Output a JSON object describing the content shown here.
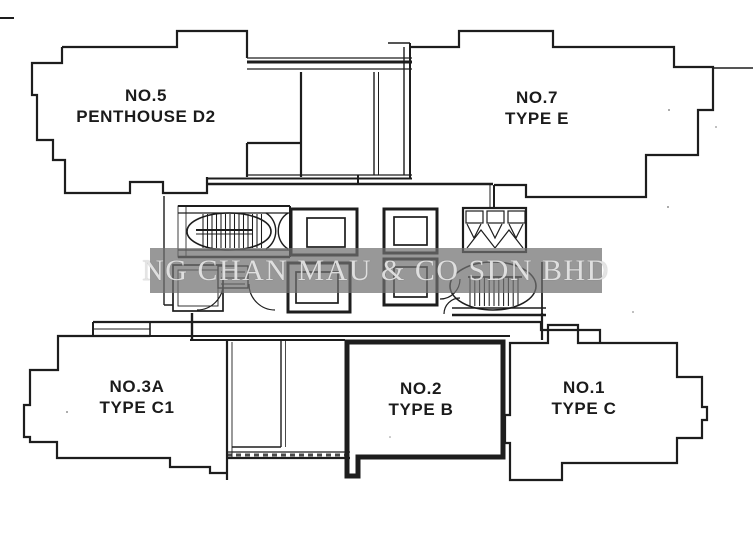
{
  "watermark": {
    "text": "NG CHAN MAU & CO SDN BHD"
  },
  "units": [
    {
      "id": "no5",
      "number": "NO.5",
      "type": "PENTHOUSE D2",
      "highlighted": false
    },
    {
      "id": "no7",
      "number": "NO.7",
      "type": "TYPE E",
      "highlighted": false
    },
    {
      "id": "no3a",
      "number": "NO.3A",
      "type": "TYPE C1",
      "highlighted": false
    },
    {
      "id": "no2",
      "number": "NO.2",
      "type": "TYPE B",
      "highlighted": true
    },
    {
      "id": "no1",
      "number": "NO.1",
      "type": "TYPE C",
      "highlighted": false
    }
  ],
  "colors": {
    "background": "#ffffff",
    "line": "#1d1d1d",
    "highlight_outline": "#0f0f0f",
    "watermark_band": "#969696",
    "watermark_text": "#e3e3e3"
  }
}
